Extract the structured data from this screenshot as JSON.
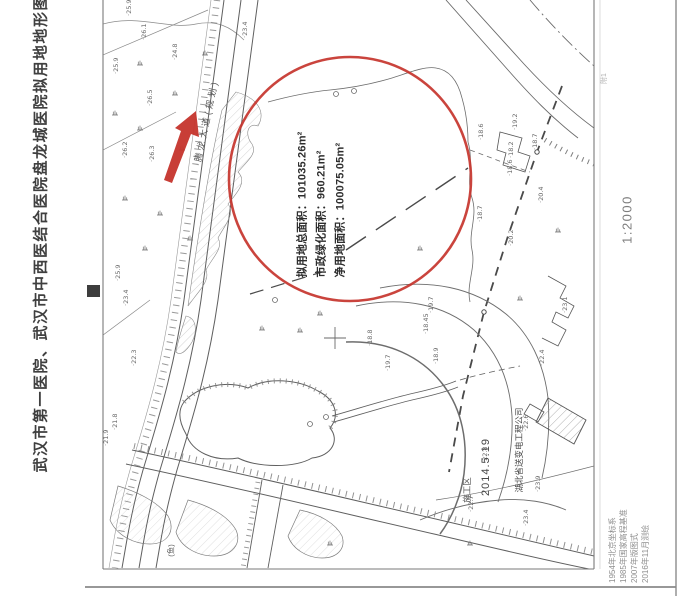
{
  "title": "武汉市第一医院、武汉市中西医结合医院盘龙城医院拟用地地形图",
  "annotation_block": {
    "lines": [
      "拟用地总面积：101035.26m²",
      "市政绿化面积：960.21m²",
      "净用地面积：100075.05m²"
    ]
  },
  "right_margin": {
    "sheet_label": "附1",
    "scale_label": "1:2000",
    "survey_notes": [
      "1954年北京坐标系",
      "1985年国家高程基准",
      "2007年版图式",
      "2016年11月测绘"
    ]
  },
  "map_labels": {
    "road_name": "腾龙大道(规划)",
    "construction_area": "施工区",
    "date_note": "2014.5.19",
    "company": "湖北省送变电工程公司",
    "fish_pond_symbol": "(鱼)"
  },
  "colors": {
    "annotation_red": "#c5342c",
    "map_line_gray": "#5f5f5f",
    "margin_text_gray": "#8f8f8f",
    "title_gray": "#3f3f3f"
  },
  "map_symbols": {
    "elevation_labels": [
      {
        "x": 131,
        "y": 16,
        "v": "·25.9"
      },
      {
        "x": 146,
        "y": 40,
        "v": "·26.1"
      },
      {
        "x": 118,
        "y": 74,
        "v": "·25.9"
      },
      {
        "x": 152,
        "y": 106,
        "v": "·26.5"
      },
      {
        "x": 127,
        "y": 158,
        "v": "·26.2"
      },
      {
        "x": 154,
        "y": 162,
        "v": "·26.3"
      },
      {
        "x": 177,
        "y": 60,
        "v": "·24.8"
      },
      {
        "x": 247,
        "y": 38,
        "v": "·23.4"
      },
      {
        "x": 120,
        "y": 281,
        "v": "·25.9"
      },
      {
        "x": 128,
        "y": 306,
        "v": "·23.4"
      },
      {
        "x": 136,
        "y": 366,
        "v": "·22.3"
      },
      {
        "x": 117,
        "y": 430,
        "v": "·21.8"
      },
      {
        "x": 108,
        "y": 446,
        "v": "·21.9"
      },
      {
        "x": 372,
        "y": 346,
        "v": "·18.8"
      },
      {
        "x": 390,
        "y": 371,
        "v": "·19.7"
      },
      {
        "x": 433,
        "y": 313,
        "v": "·19.7"
      },
      {
        "x": 428,
        "y": 334,
        "v": "·18.45"
      },
      {
        "x": 438,
        "y": 364,
        "v": "·18.9"
      },
      {
        "x": 483,
        "y": 140,
        "v": "·18.6"
      },
      {
        "x": 517,
        "y": 130,
        "v": "·19.2"
      },
      {
        "x": 513,
        "y": 158,
        "v": "·18.2"
      },
      {
        "x": 537,
        "y": 150,
        "v": "·18.7"
      },
      {
        "x": 512,
        "y": 176,
        "v": "·18.6"
      },
      {
        "x": 543,
        "y": 203,
        "v": "·20.4"
      },
      {
        "x": 482,
        "y": 222,
        "v": "·18.7"
      },
      {
        "x": 513,
        "y": 246,
        "v": "·20.2"
      },
      {
        "x": 487,
        "y": 463,
        "v": "·22.8"
      },
      {
        "x": 473,
        "y": 512,
        "v": "·22.7"
      },
      {
        "x": 540,
        "y": 492,
        "v": "·23.9"
      },
      {
        "x": 528,
        "y": 526,
        "v": "·23.4"
      },
      {
        "x": 567,
        "y": 313,
        "v": "·23.1"
      },
      {
        "x": 544,
        "y": 366,
        "v": "·22.4"
      },
      {
        "x": 528,
        "y": 431,
        "v": "·22.6"
      }
    ],
    "vegetation_marks": [
      {
        "x": 140,
        "y": 65
      },
      {
        "x": 205,
        "y": 55
      },
      {
        "x": 175,
        "y": 95
      },
      {
        "x": 140,
        "y": 130
      },
      {
        "x": 182,
        "y": 150
      },
      {
        "x": 125,
        "y": 200
      },
      {
        "x": 160,
        "y": 215
      },
      {
        "x": 145,
        "y": 250
      },
      {
        "x": 190,
        "y": 240
      },
      {
        "x": 115,
        "y": 115
      },
      {
        "x": 320,
        "y": 315
      },
      {
        "x": 420,
        "y": 250
      },
      {
        "x": 300,
        "y": 332
      },
      {
        "x": 262,
        "y": 330
      },
      {
        "x": 520,
        "y": 300
      },
      {
        "x": 558,
        "y": 232
      },
      {
        "x": 470,
        "y": 545
      },
      {
        "x": 330,
        "y": 545
      }
    ]
  }
}
